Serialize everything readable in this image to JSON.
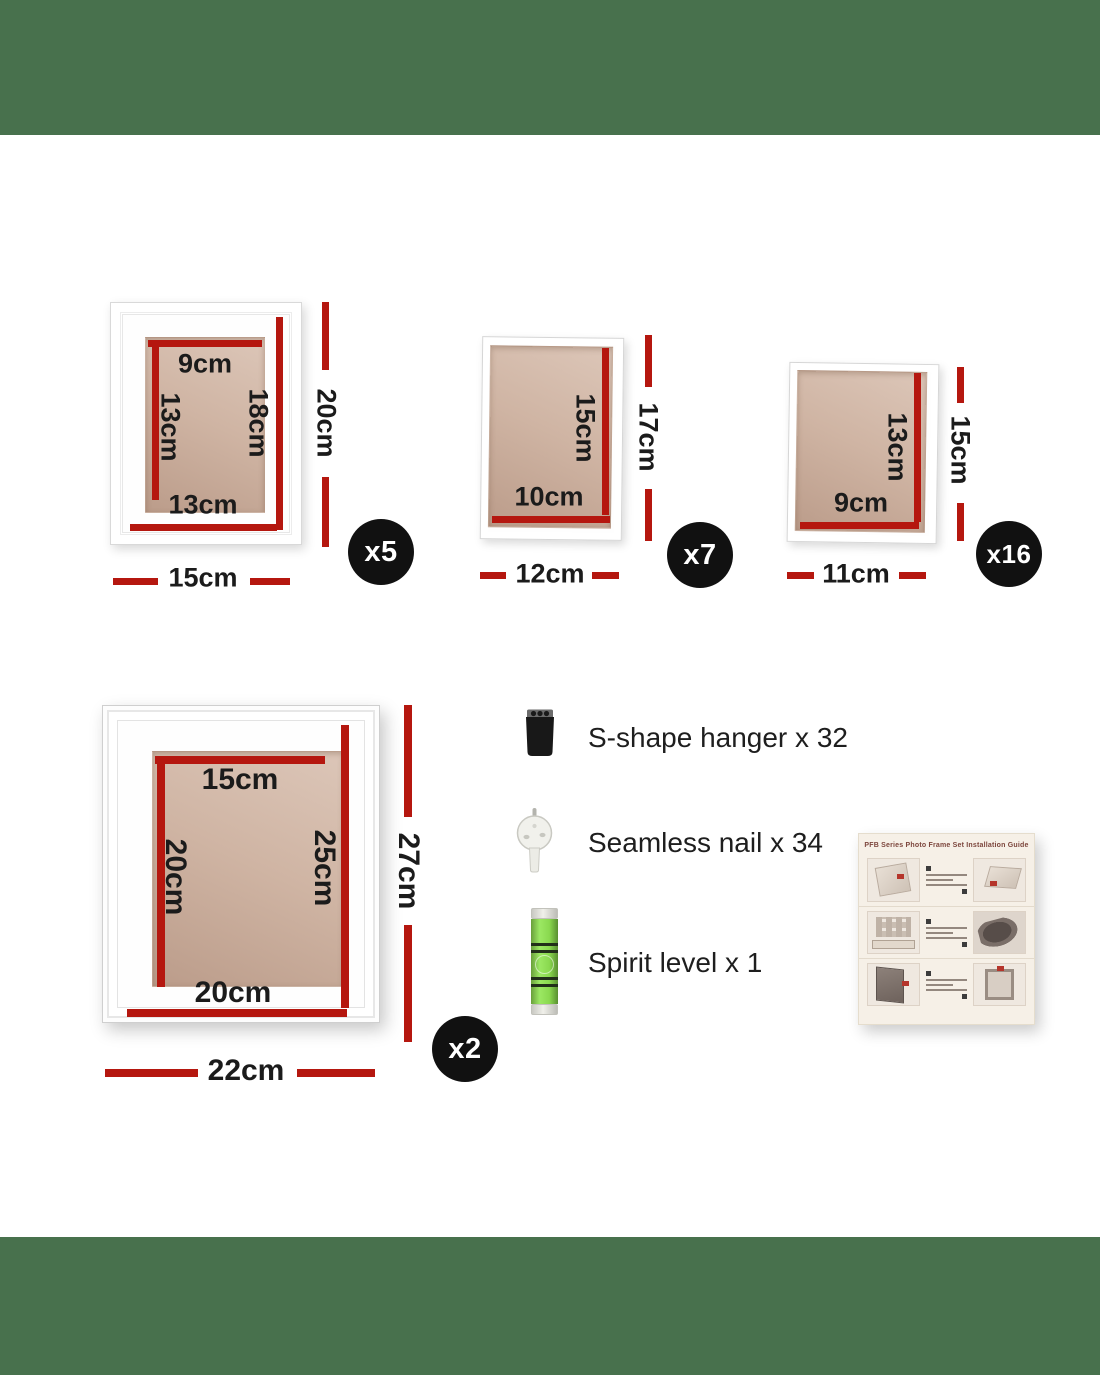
{
  "theme": {
    "green": "#48714d",
    "red": "#b5170f",
    "text": "#1b1b1b",
    "badge_bg": "#111111",
    "badge_fg": "#ffffff"
  },
  "frames": [
    {
      "name": "frame-15x20",
      "badge": "x5",
      "labels": {
        "inner_top": "9cm",
        "inner_left": "13cm",
        "inner_right": "18cm",
        "inner_bottom": "13cm",
        "outer_height": "20cm",
        "outer_width": "15cm"
      }
    },
    {
      "name": "frame-12x17",
      "badge": "x7",
      "labels": {
        "inner_right": "15cm",
        "inner_bottom": "10cm",
        "outer_height": "17cm",
        "outer_width": "12cm"
      }
    },
    {
      "name": "frame-11x15",
      "badge": "x16",
      "labels": {
        "inner_right": "13cm",
        "inner_bottom": "9cm",
        "outer_height": "15cm",
        "outer_width": "11cm"
      }
    },
    {
      "name": "frame-22x27",
      "badge": "x2",
      "labels": {
        "inner_top": "15cm",
        "inner_left": "20cm",
        "inner_right": "25cm",
        "inner_bottom": "20cm",
        "outer_height": "27cm",
        "outer_width": "22cm"
      }
    }
  ],
  "accessories": [
    {
      "icon": "s-shape-hanger-icon",
      "label": "S-shape hanger x 32"
    },
    {
      "icon": "seamless-nail-icon",
      "label": "Seamless nail x 34"
    },
    {
      "icon": "spirit-level-icon",
      "label": "Spirit level x 1"
    }
  ],
  "manual": {
    "title": "PFB Series Photo Frame Set Installation Guide"
  }
}
